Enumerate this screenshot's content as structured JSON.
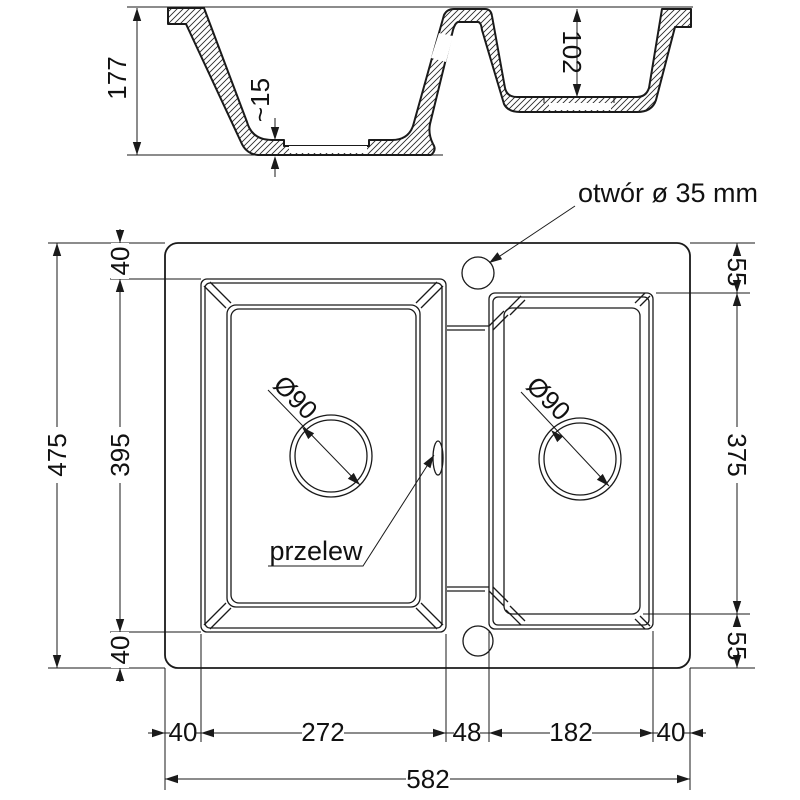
{
  "section": {
    "depth_total": "177",
    "floor_thickness": "~15",
    "bowl2_depth": "102"
  },
  "plan": {
    "faucet_hole_label": "otwór ø 35 mm",
    "overflow_label": "przelew",
    "drain_left_dia": "Ø90",
    "drain_right_dia": "Ø90",
    "total_height": "475",
    "bowl1_height": "395",
    "top_margin": "40",
    "bottom_margin": "40",
    "bowl2_top_margin": "55",
    "bowl2_height": "375",
    "bowl2_bottom_margin": "55",
    "left_margin": "40",
    "bowl1_width": "272",
    "divider_width": "48",
    "bowl2_width": "182",
    "right_margin": "40",
    "total_width": "582"
  },
  "colors": {
    "line": "#1a1a1a",
    "background": "#ffffff"
  }
}
